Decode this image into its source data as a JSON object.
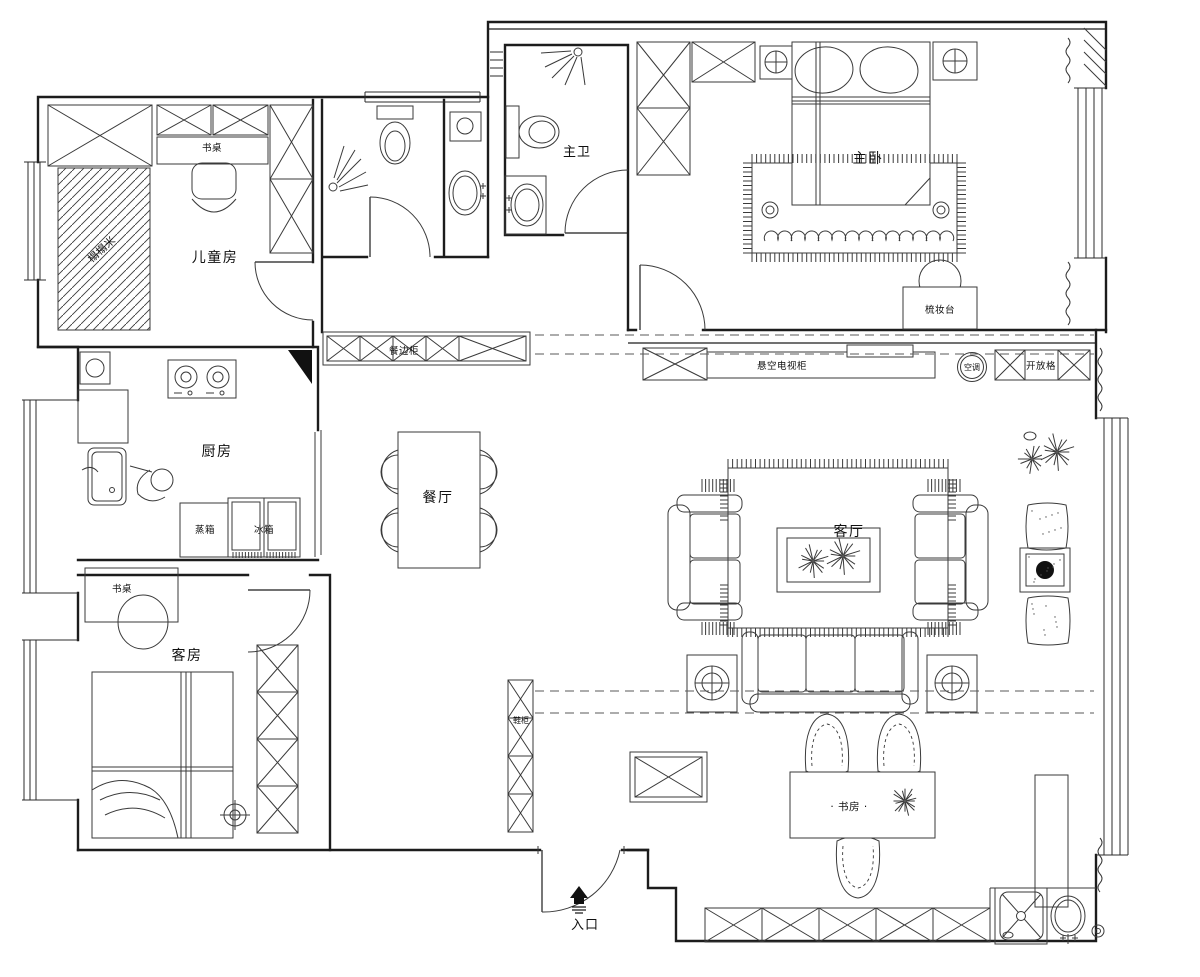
{
  "labels": {
    "children_room": "儿童房",
    "children_desk": "书桌",
    "tatami": "榻榻米",
    "master_bath": "主卫",
    "master_bedroom": "主卧",
    "dressing_table": "梳妆台",
    "sideboard": "餐边柜",
    "tv_cabinet": "悬空电视柜",
    "air_conditioner": "空调",
    "open_shelf": "开放格",
    "kitchen": "厨房",
    "steam_oven": "蒸箱",
    "fridge": "冰箱",
    "dining_room": "餐厅",
    "living_room": "客厅",
    "guest_room": "客房",
    "guest_desk": "书桌",
    "shoe_cabinet": "鞋柜",
    "study": "· 书房 ·",
    "entrance": "入口"
  }
}
